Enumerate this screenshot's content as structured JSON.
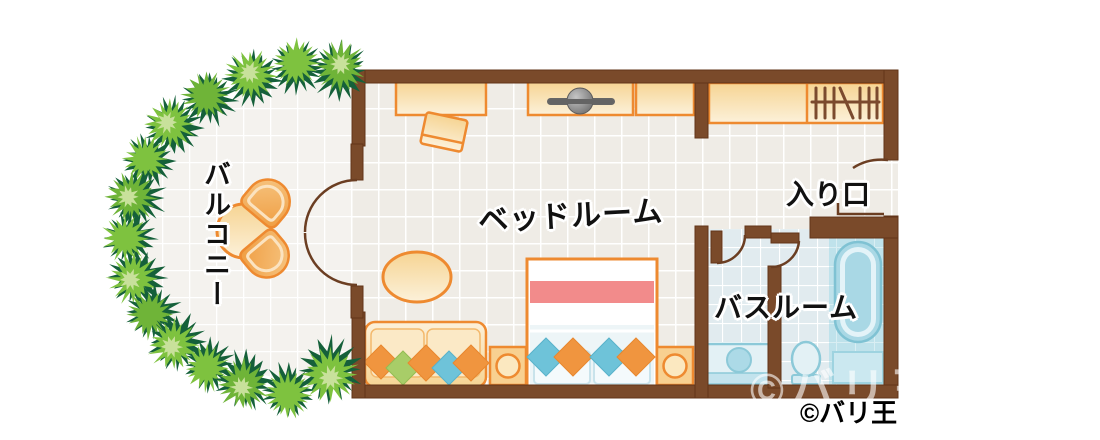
{
  "labels": {
    "balcony": "バルコニー",
    "bedroom": "ベッドルーム",
    "entrance": "入り口",
    "bathroom": "バスルーム"
  },
  "watermarks": {
    "overlay": "©バリ王",
    "caption": "©バリ王"
  },
  "palette": {
    "wall": "#7A4A2A",
    "wall_line": "#623418",
    "door_swing_line": "#6B3E22",
    "furniture_outline": "#EE8A30",
    "furniture_fill_light": "#FCF1DA",
    "furniture_fill_dark": "#F6D493",
    "floor_bedroom": "#EFECE6",
    "floor_balcony": "#F4F2EE",
    "floor_bath_tile": "#E1EBEF",
    "floor_bath_blue": "#BFE2EB",
    "bed_blanket_pink": "#F28B8B",
    "cushion_orange": "#F0953F",
    "cushion_green": "#A8CD68",
    "cushion_blue": "#6EC3D9",
    "bath_fixture_line": "#8CC9D8",
    "bath_fixture_fill": "#E3F1F5",
    "hedge_dark": "#15603A",
    "hedge_green": "#7EC23F",
    "hedge_green_alt": "#6FB438",
    "hedge_light": "#C8E19B",
    "tv_gray": "#666666"
  },
  "rooms": [
    {
      "id": "balcony",
      "label": "バルコニー",
      "items": [
        "hedge",
        "round-table",
        "chair",
        "chair"
      ]
    },
    {
      "id": "bedroom",
      "label": "ベッドルーム",
      "items": [
        "desk",
        "desk-chair",
        "tv-cabinet",
        "tv",
        "cabinet",
        "coffee-table",
        "sofa",
        "double-bed",
        "nightstand-left",
        "nightstand-right",
        "french-door"
      ]
    },
    {
      "id": "entrance-hall",
      "label": "入り口",
      "items": [
        "closet-counter",
        "hanger-rack",
        "entrance-door"
      ]
    },
    {
      "id": "bathroom",
      "label": "バスルーム",
      "items": [
        "vanity-sink",
        "toilet",
        "bathtub",
        "partition-wall",
        "door",
        "door"
      ]
    }
  ]
}
